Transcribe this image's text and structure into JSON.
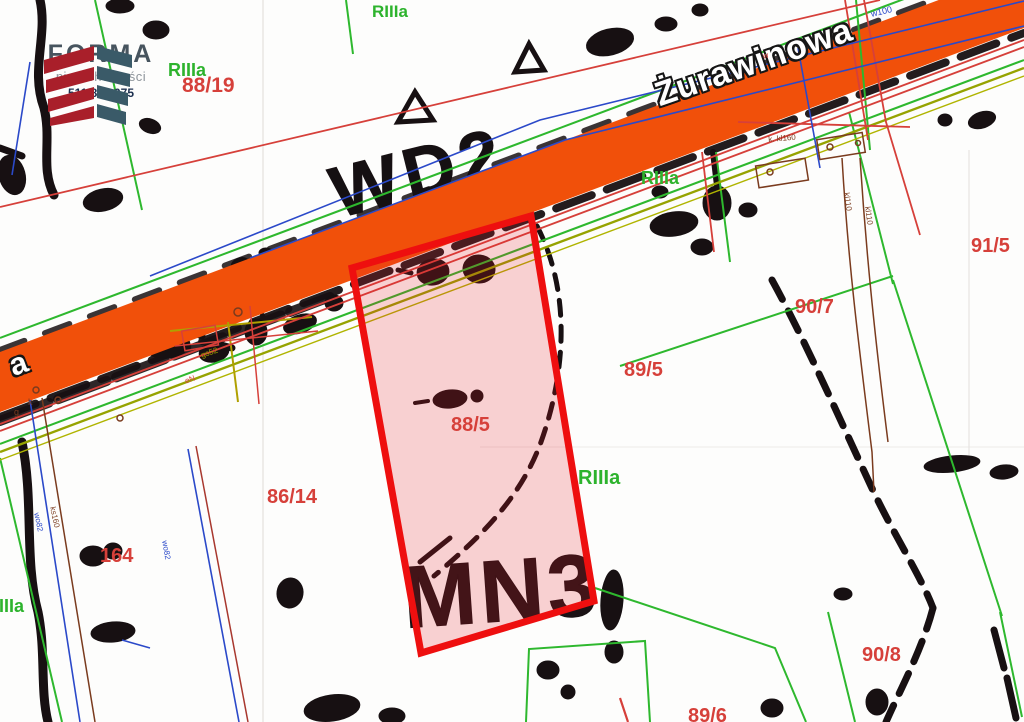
{
  "branding": {
    "logo_text": "FORMA",
    "logo_subtext": "nieruchomości",
    "phone": "511 893 075"
  },
  "road": {
    "name": "Żurawinowa",
    "partial_label": "a"
  },
  "highlight": {
    "parcel_number": "88/5",
    "border_color": "#ee0f0f",
    "fill_tint": "rgba(228,28,38,0.20)"
  },
  "scan_text": {
    "zone_big": "MN3",
    "road_zone": "WD2"
  },
  "colors": {
    "road_fill": "#f1500a",
    "parcel_text": "#d6403a",
    "soil_text": "#2db32d",
    "green_line": "#2eb82e",
    "olive_line": "#96a300",
    "thin_red_line": "#d6403a",
    "blue_line": "#2b49c9",
    "brown_line": "#7a3b1e",
    "scan_ink": "#171012"
  },
  "parcel_labels": [
    {
      "text": "88/19",
      "x": 182,
      "y": 75,
      "size": 21
    },
    {
      "text": "91/5",
      "x": 971,
      "y": 236,
      "size": 20
    },
    {
      "text": "90/7",
      "x": 795,
      "y": 297,
      "size": 20
    },
    {
      "text": "89/5",
      "x": 624,
      "y": 360,
      "size": 20
    },
    {
      "text": "88/5",
      "x": 451,
      "y": 415,
      "size": 20
    },
    {
      "text": "86/14",
      "x": 267,
      "y": 487,
      "size": 20
    },
    {
      "text": "164",
      "x": 100,
      "y": 546,
      "size": 20
    },
    {
      "text": "90/8",
      "x": 862,
      "y": 645,
      "size": 20
    },
    {
      "text": "89/6",
      "x": 688,
      "y": 706,
      "size": 20
    }
  ],
  "soil_labels": [
    {
      "text": "RIIIa",
      "x": 168,
      "y": 61,
      "size": 18
    },
    {
      "text": "RIIIa",
      "x": 372,
      "y": 3,
      "size": 17
    },
    {
      "text": "RIIIa",
      "x": 641,
      "y": 169,
      "size": 18
    },
    {
      "text": "RIIIa",
      "x": 578,
      "y": 468,
      "size": 20
    },
    {
      "text": "RIIIa",
      "x": -14,
      "y": 597,
      "size": 18
    }
  ],
  "utility_labels": [
    {
      "text": "w100",
      "x": 870,
      "y": 10,
      "rot": -13,
      "color": "#2b49c9",
      "size": 9
    },
    {
      "text": "wo82",
      "x": 40,
      "y": 512,
      "rot": 78,
      "color": "#2b49c9",
      "size": 8
    },
    {
      "text": "ks160",
      "x": 56,
      "y": 506,
      "rot": 78,
      "color": "#7a3b1e",
      "size": 8
    },
    {
      "text": "wo82",
      "x": 168,
      "y": 540,
      "rot": 80,
      "color": "#2b49c9",
      "size": 8
    },
    {
      "text": "gs52",
      "x": 200,
      "y": 352,
      "rot": -18,
      "color": "#a0a000",
      "size": 8
    },
    {
      "text": "eN",
      "x": 184,
      "y": 378,
      "rot": -20,
      "color": "#d6403a",
      "size": 8
    },
    {
      "text": "k. kl160",
      "x": 768,
      "y": 136,
      "rot": -5,
      "color": "#7a3b1e",
      "size": 8
    },
    {
      "text": "kl110",
      "x": 850,
      "y": 192,
      "rot": 82,
      "color": "#7a3b1e",
      "size": 8
    },
    {
      "text": "kl110",
      "x": 871,
      "y": 206,
      "rot": 82,
      "color": "#7a3b1e",
      "size": 8
    },
    {
      "text": "w",
      "x": 762,
      "y": 53,
      "rot": -15,
      "color": "#d6403a",
      "size": 8
    },
    {
      "text": "g",
      "x": 14,
      "y": 408,
      "rot": 0,
      "color": "#7a3b1e",
      "size": 9
    },
    {
      "text": "k",
      "x": 28,
      "y": 398,
      "rot": 0,
      "color": "#7a3b1e",
      "size": 9
    }
  ]
}
